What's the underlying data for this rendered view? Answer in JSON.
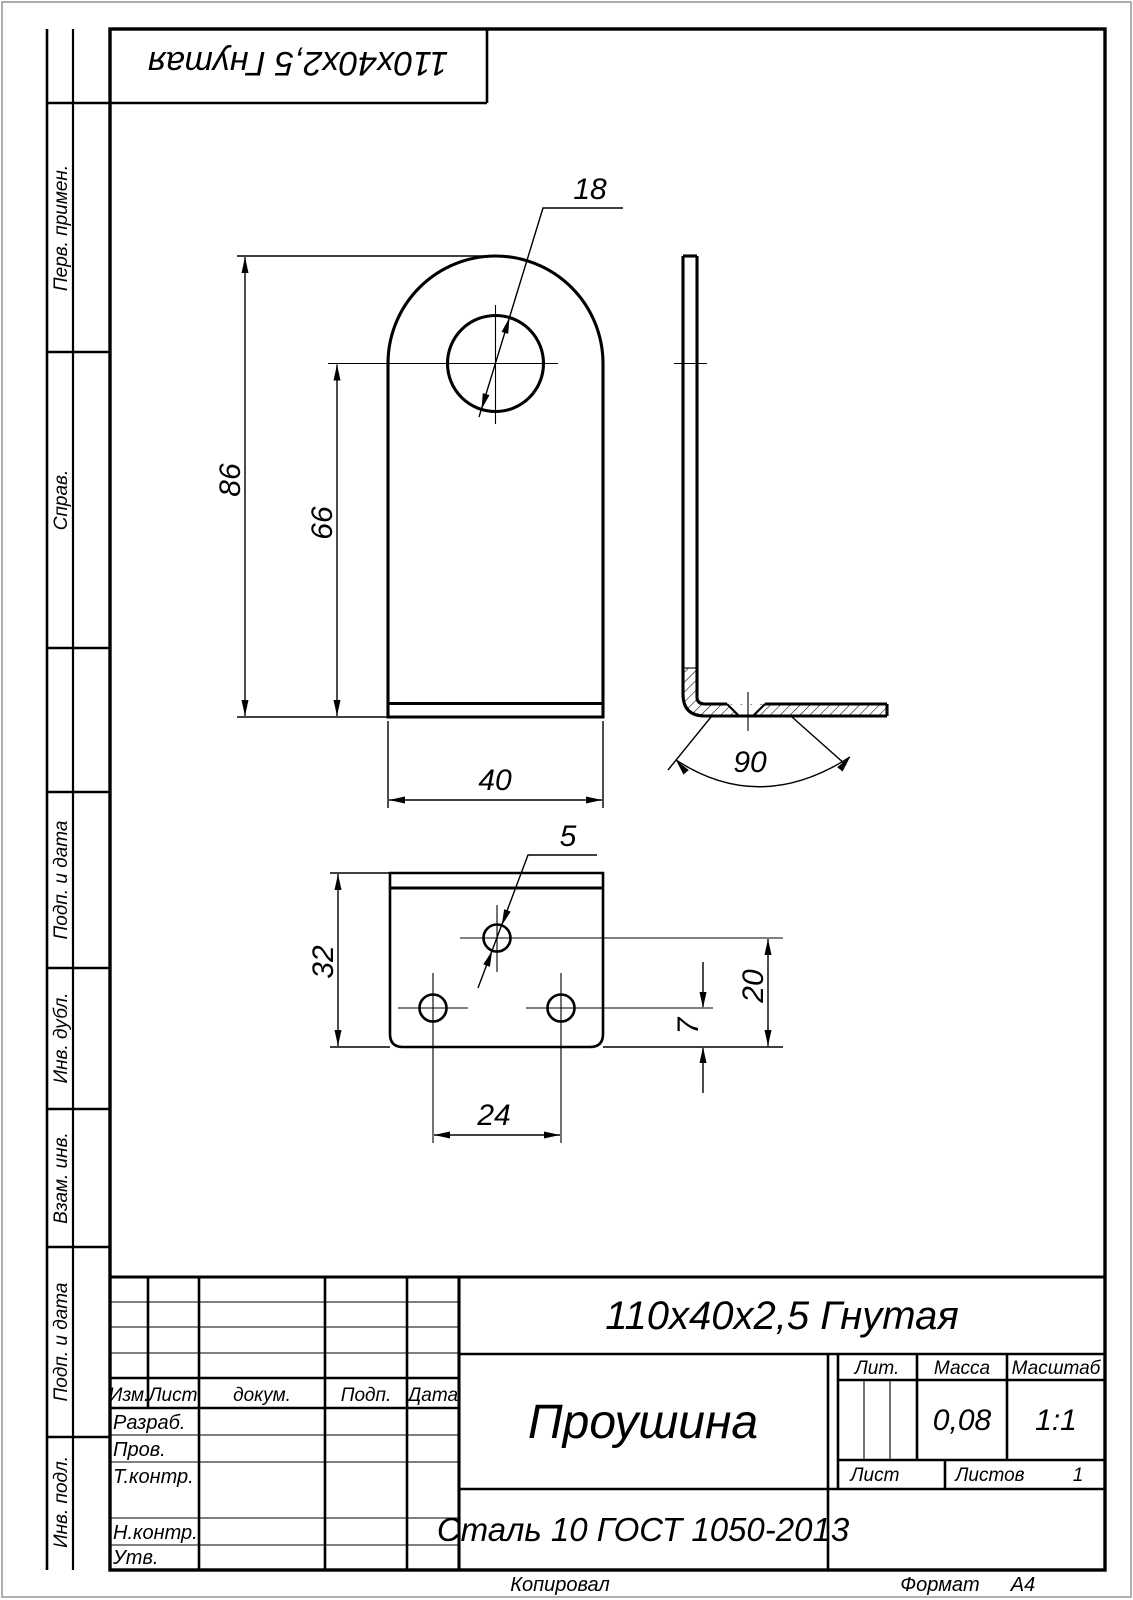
{
  "sheet": {
    "corner_stamp": "110x40x2,5 Гнутая",
    "margin_labels": [
      "Перв. примен.",
      "Справ.",
      "Подп. и дата",
      "Инв. дубл.",
      "Взам. инв.",
      "Подп. и дата",
      "Инв. подл."
    ]
  },
  "dimensions": {
    "height_total": "86",
    "height_hole": "66",
    "width": "40",
    "hole_diameter": "18",
    "bend_angle": "90",
    "flange_hole_diameter": "5",
    "flange_width": "32",
    "flange_hole_spacing": "24",
    "flange_edge_offset": "7",
    "flange_hole_offset": "20"
  },
  "title_block": {
    "designation": "110x40x2,5 Гнутая",
    "part_name": "Проушина",
    "material": "Сталь 10  ГОСТ 1050-2013",
    "mass": "0,08",
    "scale": "1:1",
    "sheets": "1",
    "headers": {
      "izm": "Изм.",
      "list": "Лист",
      "dokum": "докум.",
      "podp": "Подп.",
      "data": "Дата",
      "lit": "Лит.",
      "massa": "Масса",
      "masshtab": "Масштаб",
      "list2": "Лист",
      "listov": "Листов"
    },
    "signature_rows": {
      "razrab": "Разраб.",
      "prov": "Пров.",
      "tkontr": "Т.контр.",
      "nkontr": "Н.контр.",
      "utv": "Утв."
    },
    "footer": {
      "kopiroval": "Копировал",
      "format_label": "Формат",
      "format_value": "А4"
    }
  }
}
